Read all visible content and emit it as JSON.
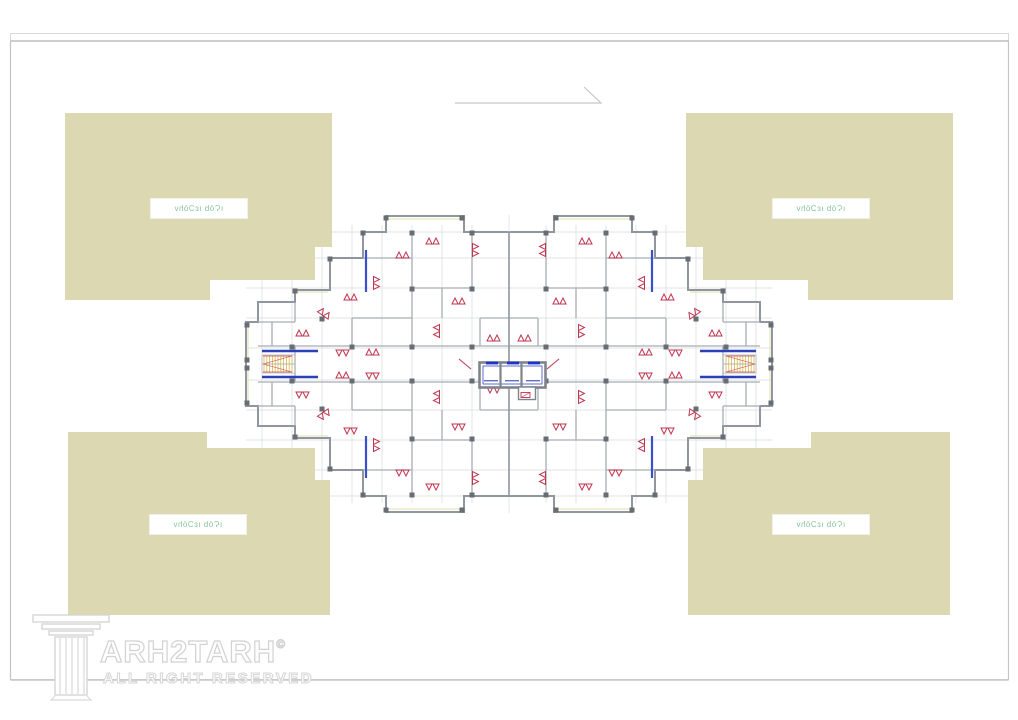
{
  "masks": {
    "fill": "#dbd8b2",
    "label": "ıϚōb ıɛƆöhv",
    "label_color": "#86c79b"
  },
  "watermark": {
    "brand": "ARH2TARH",
    "copyright": "©",
    "rights": "ALL RIGHT RESERVED",
    "icon": "classical-column-icon"
  },
  "plan": {
    "wall_color": "#8f96a0",
    "interior_wall_color": "#a7acb4",
    "grid_color": "#d8dbde",
    "door_swing_color": "#c0354f",
    "core_blue": "#2a3fb8",
    "elevator_door_blue": "#1e34c8",
    "stair_hatch_yellow": "#d8b84a",
    "column_fill": "#686d73",
    "window_accent": "#e2e6bb",
    "frame_border": "#cfcfcf"
  }
}
